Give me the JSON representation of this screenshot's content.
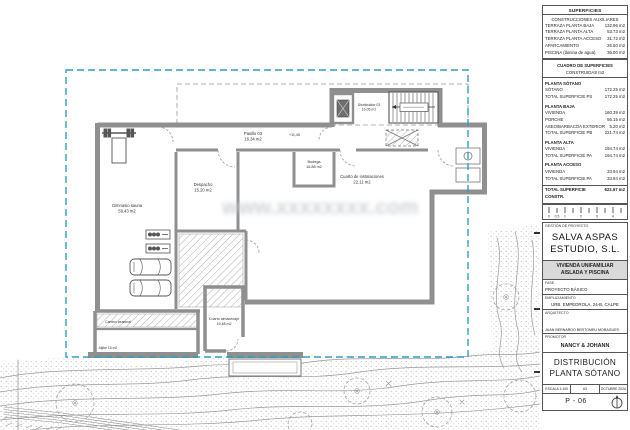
{
  "panel": {
    "surfaces_aux": {
      "title": "SUPERFICIES",
      "subtitle": "CONSTRUCCIONES AUXILIARES",
      "rows": [
        {
          "label": "TERRAZA PLANTA BAJA",
          "value": "132.96 m2"
        },
        {
          "label": "TERRAZA PLANTA ALTA",
          "value": "53.73 m2"
        },
        {
          "label": "TERRAZA PLANTA ACCESO",
          "value": "31.72 m2"
        },
        {
          "label": "APARCAMIENTO",
          "value": "26.50 m2"
        },
        {
          "label": "PISCINA (lámina de agua)",
          "value": "36.00 m2"
        }
      ]
    },
    "surfaces_built": {
      "title": "CUADRO DE SUPERFICIES",
      "subtitle": "CONSTRUIDAS m2",
      "sections": [
        {
          "heading": "PLANTA SÓTANO",
          "rows": [
            {
              "label": "SÓTANO",
              "value": "172.25 m2"
            },
            {
              "label": "TOTAL SUPERFICIE PS",
              "value": "172.25 m2"
            }
          ]
        },
        {
          "heading": "PLANTA BAJA",
          "rows": [
            {
              "label": "VIVIENDA",
              "value": "160.39 m2"
            },
            {
              "label": "PORCHE",
              "value": "56.15 m2"
            },
            {
              "label": "ASEO/BARBACOA EXTERIOR",
              "value": "5.20 m2"
            },
            {
              "label": "TOTAL SUPERFICIE PB",
              "value": "221.74 m2"
            }
          ]
        },
        {
          "heading": "PLANTA ALTA",
          "rows": [
            {
              "label": "VIVIENDA",
              "value": "194.74 m2"
            },
            {
              "label": "TOTAL SUPERFICIE PA",
              "value": "194.74 m2"
            }
          ]
        },
        {
          "heading": "PLANTA ACCESO",
          "rows": [
            {
              "label": "VIVIENDA",
              "value": "33.94 m2"
            },
            {
              "label": "TOTAL SUPERFICIE PA",
              "value": "33.94 m2"
            }
          ]
        }
      ],
      "total": {
        "label": "TOTAL SUPERFICIE CONSTR.",
        "value": "622.67 m2"
      }
    },
    "scale_bar": {
      "labels": [
        "0",
        "0,5",
        "1",
        "2",
        "3",
        "4"
      ]
    },
    "management_label": "GESTIÓN DE PROYECTO",
    "studio_line1": "SALVA ASPAS",
    "studio_line2": "ESTUDIO, S.L.",
    "project_title_line1": "VIVIENDA UNIFAMILIAR",
    "project_title_line2": "AISLADA Y PISCINA",
    "fase_label": "FASE",
    "fase_value": "PROYECTO BÁSICO",
    "emplazamiento_label": "EMPLAZAMIENTO",
    "emplazamiento_value": "URB. EMPEDROLA, 24-B, CALPE",
    "arquitecto_label": "ARQUITECTO",
    "arquitecto_value": "JUAN BERNARDO BERTOMEU MORAGUES",
    "promotor_label": "PROMOTOR",
    "promotor_value": "NANCY & JOHANN",
    "drawing_title_line1": "DISTRIBUCIÓN",
    "drawing_title_line2": "PLANTA SÓTANO",
    "escala": "ESCALA 1:100",
    "paper_size": "A3",
    "date": "OCTUBRE 2024",
    "sheet_number": "P - 06"
  },
  "plan": {
    "rooms": {
      "gimnasio": {
        "line1": "Gimnasio sauna",
        "line2": "59.43 m2"
      },
      "despacho": {
        "line1": "Despacho",
        "line2": "15.20 m2"
      },
      "pasillo": {
        "line1": "Pasillo 03",
        "line2": "16.34 m2"
      },
      "bodega": {
        "line1": "Bodega",
        "line2": "16.88 m2"
      },
      "distribuidor": {
        "line1": "Distribuidor 03",
        "line2": "16.05 m2"
      },
      "instalaciones": {
        "line1": "Cuarto de instalaciones",
        "line2": "22.11 m2"
      },
      "almacenaje": {
        "line1": "Cuarto almacenaje",
        "line2": "19.48 m2"
      },
      "camino": {
        "line1": "Camino peatonal",
        "line2": ""
      },
      "aljibe": {
        "line1": "Aljibe 15 m2",
        "line2": ""
      }
    },
    "annotations": {
      "level": "+11,45"
    },
    "watermark": "www.xxxxxxxx.com"
  },
  "colors": {
    "boundary_dashed": "#2f9fc0",
    "wall_gray": "#8f8f8f",
    "band_gray": "#d9d9d9",
    "terrain_line": "#9a9a9a"
  }
}
